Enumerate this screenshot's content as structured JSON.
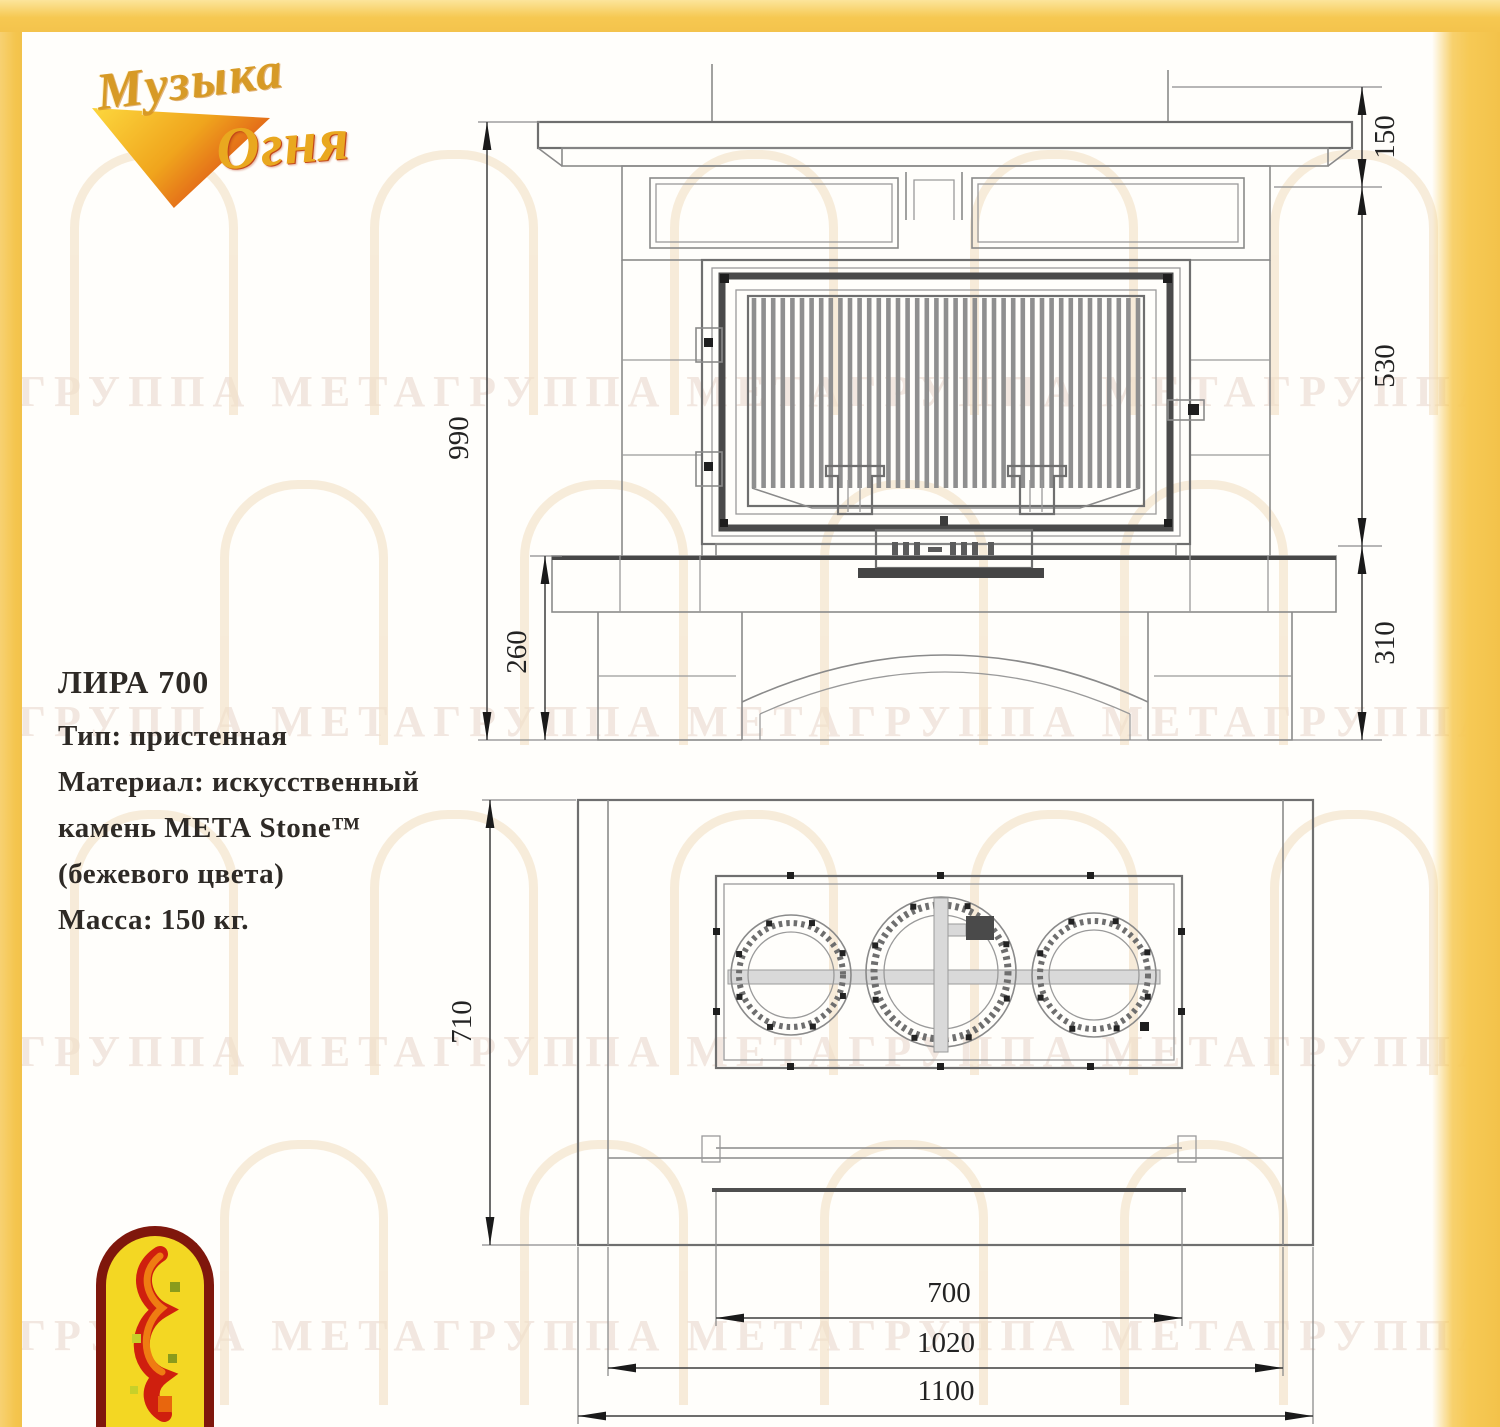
{
  "brand_logo": {
    "word1": "Музыка",
    "word2": "Огня"
  },
  "product_info": {
    "title": "ЛИРА 700",
    "lines": [
      "Тип: пристенная",
      "Материал: искусственный",
      "камень МЕТА Stone™",
      "(бежевого цвета)",
      "Масса: 150 кг."
    ]
  },
  "front_view": {
    "dim_total_height": "990",
    "dim_hearth_height": "260",
    "dim_mantel_offset": "150",
    "dim_firebox_height": "530",
    "dim_base_height": "310"
  },
  "plan_view": {
    "dim_depth": "710",
    "dim_firebox_width": "700",
    "dim_body_width": "1020",
    "dim_overall_width": "1100"
  },
  "watermark": {
    "row_text": "ГРУППА МЕТАГРУППА МЕТАГРУППА МЕТАГРУППА МЕТА"
  }
}
